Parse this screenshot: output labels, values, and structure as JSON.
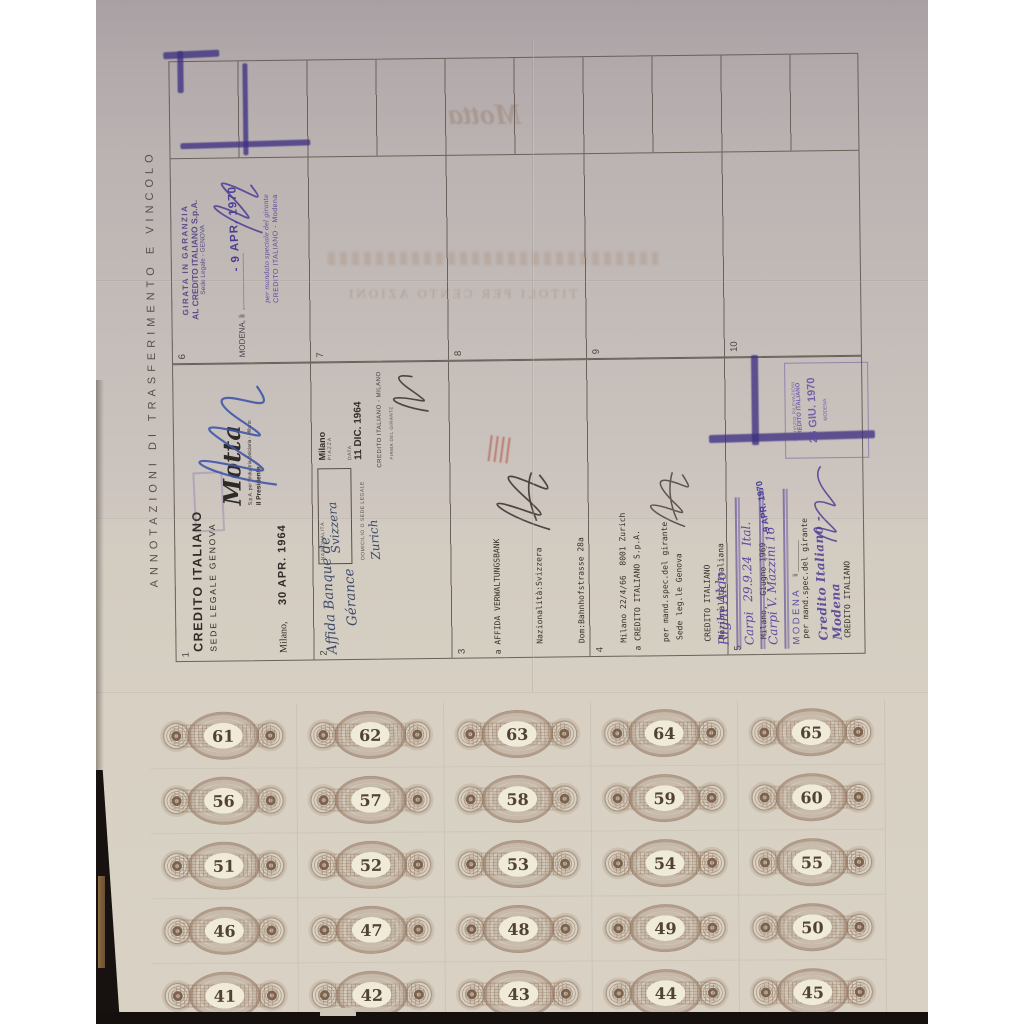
{
  "vertical_title": "ANNOTAZIONI DI TRASFERIMENTO E VINCOLO",
  "table": {
    "upper_numbers": [
      "6",
      "7",
      "8",
      "9",
      "10"
    ],
    "lower_numbers": [
      "1",
      "2",
      "3",
      "4",
      "5"
    ]
  },
  "sections": {
    "s6": {
      "stamp1": "GIRATA IN GARANZIA",
      "stamp2": "AL CREDITO ITALIANO S.p.A.",
      "stamp3": "Sede Legale - GENOVA",
      "place": "MODENA, li",
      "date": "- 9 APR. 1970",
      "small1": "per mandato speciale del girante",
      "small2": "CREDITO ITALIANO - Modena"
    },
    "s1": {
      "stamp1": "CREDITO ITALIANO",
      "stamp2": "SEDE LEGALE GENOVA",
      "place": "Milano,",
      "date": "30 APR. 1964",
      "motta": "Motta",
      "motta_sub": "S.p.A. per l'Industria Dolciaria - Milano",
      "motta_role": "Il Presidente"
    },
    "s2": {
      "hand1": "Affida Banque de",
      "hand2": "Gérance",
      "lbl_naz": "NAZIONALITÀ",
      "val_naz": "Svizzera",
      "lbl_dom": "DOMICILIO O SEDE LEGALE",
      "val_dom": "Zurich",
      "lbl_city": "Milano",
      "lbl_piazza": "PIAZZA",
      "lbl_data": "DATA",
      "date": "11 DIC. 1964",
      "bank": "CREDITO ITALIANO - MILANO",
      "lbl_firma": "FIRMA DEL GIRANTE"
    },
    "s3": {
      "lines": [
        "a AFFIDA VERWALTUNGSBANK",
        "Nazionalità:Svizzera",
        "Dom:Bahnhofstrasse 28a",
        "Milano 22/4/66  8001 Zurich",
        "per mand.spec.del girante",
        "CREDITO ITALIANO"
      ]
    },
    "s4": {
      "lines": [
        "a CREDITO ITALIANO S.p.A.",
        "Sede leg.le Genova",
        "Nazionalità Italiana",
        "Milano,  Giugno 1969",
        "per mand.spec.del girante",
        "CREDITO ITALIANO"
      ]
    },
    "s5": {
      "l1": "Righi Aldo",
      "l2": "Carpi  29.9.24  Ital.",
      "l3": "Carpi  V. Mazzini 16",
      "modena": "MODENA",
      "li": "li",
      "date": "-9 APR. 1970",
      "bank": "Credito Italiano - Modena"
    },
    "box_stamp": {
      "lines": [
        "SERVIZIO RILEVAZIONI",
        "CREDITO ITALIANO",
        "26 GIU. 1970",
        "MODENA"
      ]
    }
  },
  "ghost": {
    "title": "TITOLI PER CENTO AZIONI",
    "motta": "Motta"
  },
  "coupons": {
    "rows": [
      [
        61,
        62,
        63,
        64,
        65
      ],
      [
        56,
        57,
        58,
        59,
        60
      ],
      [
        51,
        52,
        53,
        54,
        55
      ],
      [
        46,
        47,
        48,
        49,
        50
      ],
      [
        41,
        42,
        43,
        44,
        45
      ]
    ]
  },
  "colors": {
    "purple_ink": "#4b3d94",
    "blue_pen": "#3f58a8",
    "stamp_black": "#332e29",
    "guilloche_brown": "#967a64",
    "paper": "#cfc8bc",
    "red_stamp": "#b24d40"
  }
}
